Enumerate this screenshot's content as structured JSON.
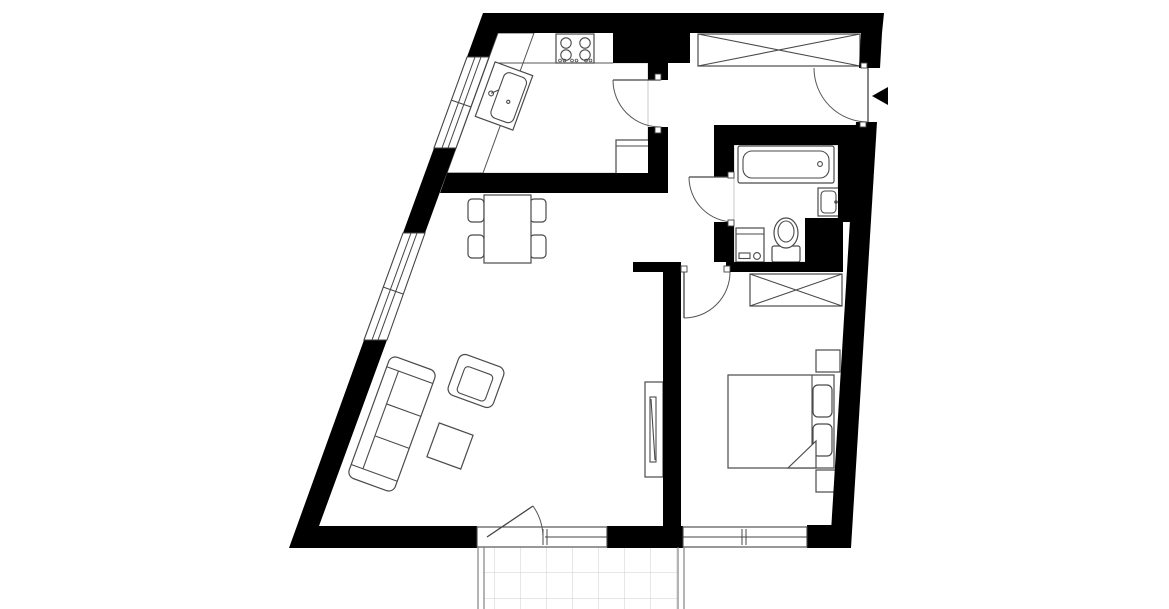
{
  "meta": {
    "title": "Apartment floor plan",
    "drawing_type": "architectural-floor-plan",
    "view": "top-down"
  },
  "colors": {
    "background": "#ffffff",
    "walls": "#000000",
    "furniture_outline": "#4a4a4a",
    "tile_grid": "#d9d9d9",
    "window_frame": "#444444",
    "entrance_marker": "#000000"
  },
  "rooms": [
    {
      "name": "kitchen",
      "floor": "ceramic-tile-grid",
      "fixtures": [
        "counter-top",
        "cooktop-4-burners",
        "kitchen-sink",
        "refrigerator"
      ],
      "openings": [
        "door-to-hall",
        "window-on-slanted-wall"
      ]
    },
    {
      "name": "entrance-hall",
      "floor": "plain",
      "fixtures": [
        "wardrobe-crossed"
      ],
      "openings": [
        "entrance-door-with-arrow-marker"
      ]
    },
    {
      "name": "bathroom",
      "floor": "ceramic-tile-grid",
      "fixtures": [
        "bathtub",
        "washbasin",
        "toilet",
        "washing-machine"
      ],
      "openings": [
        "door-to-corridor"
      ]
    },
    {
      "name": "living-room",
      "floor": "plain",
      "fixtures": [
        "dining-table",
        "dining-chairs-x4",
        "sofa-3-seat",
        "armchair",
        "coffee-table",
        "tv-cabinet"
      ],
      "openings": [
        "balcony-door",
        "window-on-slanted-wall",
        "passage-to-corridor"
      ]
    },
    {
      "name": "bedroom",
      "floor": "plain",
      "fixtures": [
        "double-bed",
        "pillows-x2",
        "nightstand-x2",
        "wardrobe-crossed"
      ],
      "openings": [
        "door-from-corridor",
        "window-to-balcony-side"
      ]
    },
    {
      "name": "balcony",
      "floor": "tile-grid",
      "fixtures": [
        "railing-left",
        "railing-right"
      ],
      "openings": []
    }
  ],
  "doors": [
    {
      "name": "entrance-door",
      "wall": "right",
      "swing": "into-hall",
      "marker": "black-triangle-pointing-in"
    },
    {
      "name": "kitchen-door",
      "wall": "kitchen-right",
      "swing": "into-kitchen"
    },
    {
      "name": "bathroom-door",
      "wall": "bathroom-left",
      "swing": "into-corridor"
    },
    {
      "name": "bedroom-door",
      "wall": "bedroom-top",
      "swing": "into-bedroom"
    },
    {
      "name": "balcony-door",
      "wall": "living-room-bottom",
      "swing": "into-living-room"
    }
  ],
  "windows": [
    {
      "name": "kitchen-window",
      "wall": "left-slanted"
    },
    {
      "name": "living-room-window",
      "wall": "left-slanted"
    },
    {
      "name": "living-room-balcony-window",
      "wall": "bottom"
    },
    {
      "name": "bedroom-window",
      "wall": "bottom"
    }
  ]
}
